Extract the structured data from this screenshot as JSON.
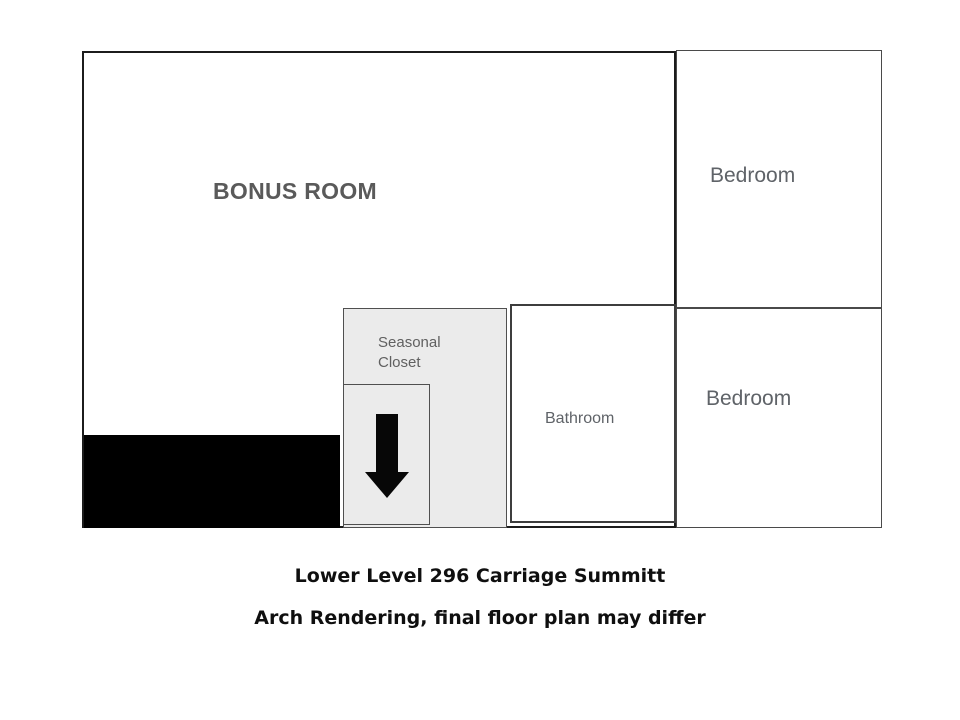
{
  "floor_plan": {
    "rooms": {
      "bonus_room": {
        "label": "BONUS ROOM"
      },
      "bedroom_top": {
        "label": "Bedroom"
      },
      "bedroom_middle": {
        "label": "Bedroom"
      },
      "bathroom": {
        "label": "Bathroom"
      },
      "seasonal_closet": {
        "label": "Seasonal Closet"
      }
    },
    "stairs": {
      "icon": "arrow-down",
      "block_fill": "#000000"
    },
    "colors": {
      "outer_wall": "#1c1c1c",
      "inner_wall": "#4a4a4a",
      "room_label_gray": "#5f6368",
      "bonus_label_gray": "#5a5a5a",
      "closet_fill": "#ebebeb",
      "background": "#ffffff"
    }
  },
  "captions": {
    "title": "Lower Level 296 Carriage Summitt",
    "disclaimer": "Arch Rendering, final floor plan may differ"
  }
}
